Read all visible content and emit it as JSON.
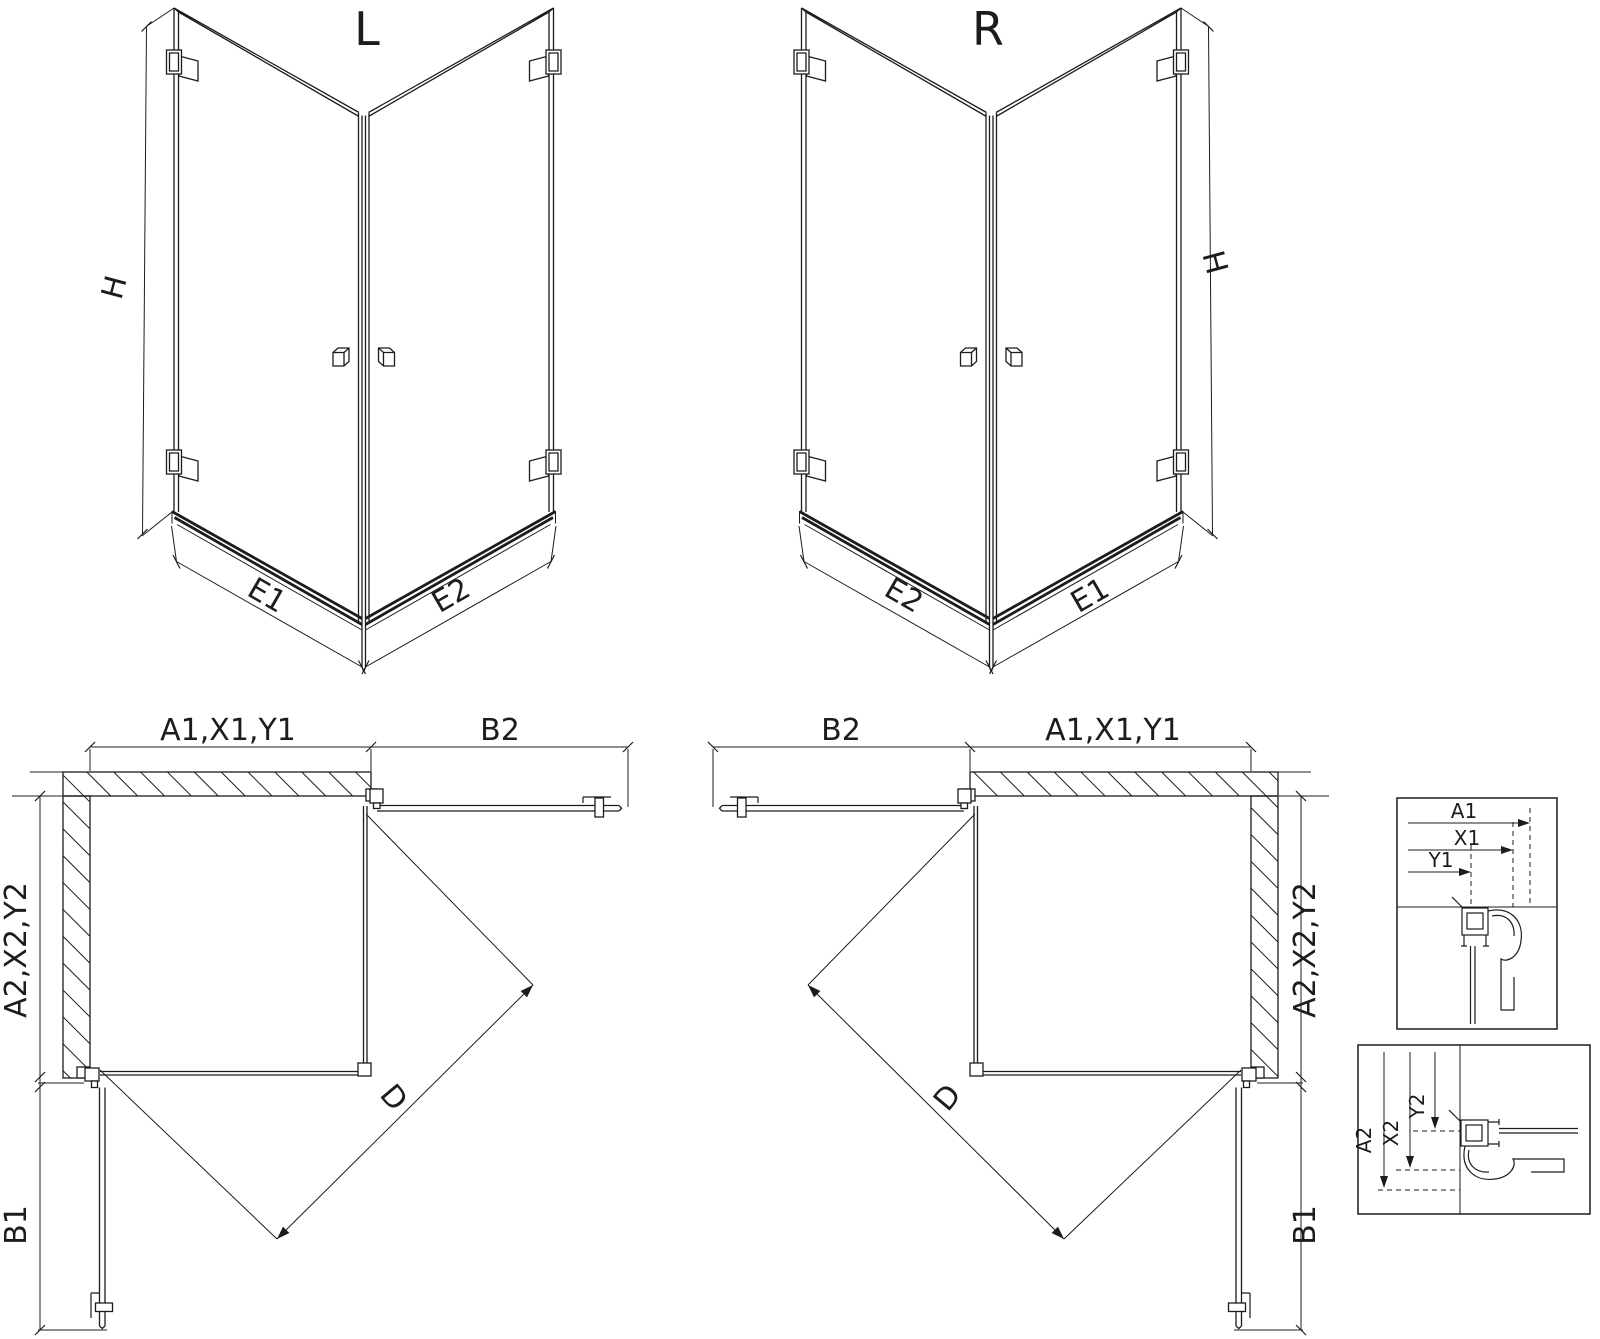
{
  "colors": {
    "line": "#1c1c1c",
    "background": "#ffffff"
  },
  "iso_views": {
    "left": {
      "label": "L",
      "height_dim": "H",
      "base_dims": {
        "left": "E1",
        "right": "E2"
      }
    },
    "right": {
      "label": "R",
      "height_dim": "H",
      "base_dims": {
        "left": "E2",
        "right": "E1"
      }
    }
  },
  "plan_views": {
    "left": {
      "top_dims": {
        "left": "A1,X1,Y1",
        "right": "B2"
      },
      "side_dims": {
        "upper": "A2,X2,Y2",
        "lower": "B1"
      },
      "diagonal_dim": "D"
    },
    "right": {
      "top_dims": {
        "left": "B2",
        "right": "A1,X1,Y1"
      },
      "side_dims": {
        "upper": "A2,X2,Y2",
        "lower": "B1"
      },
      "diagonal_dim": "D"
    }
  },
  "detail_views": {
    "top": {
      "dims": [
        "A1",
        "X1",
        "Y1"
      ]
    },
    "bottom": {
      "dims": [
        "A2",
        "X2",
        "Y2"
      ]
    }
  }
}
